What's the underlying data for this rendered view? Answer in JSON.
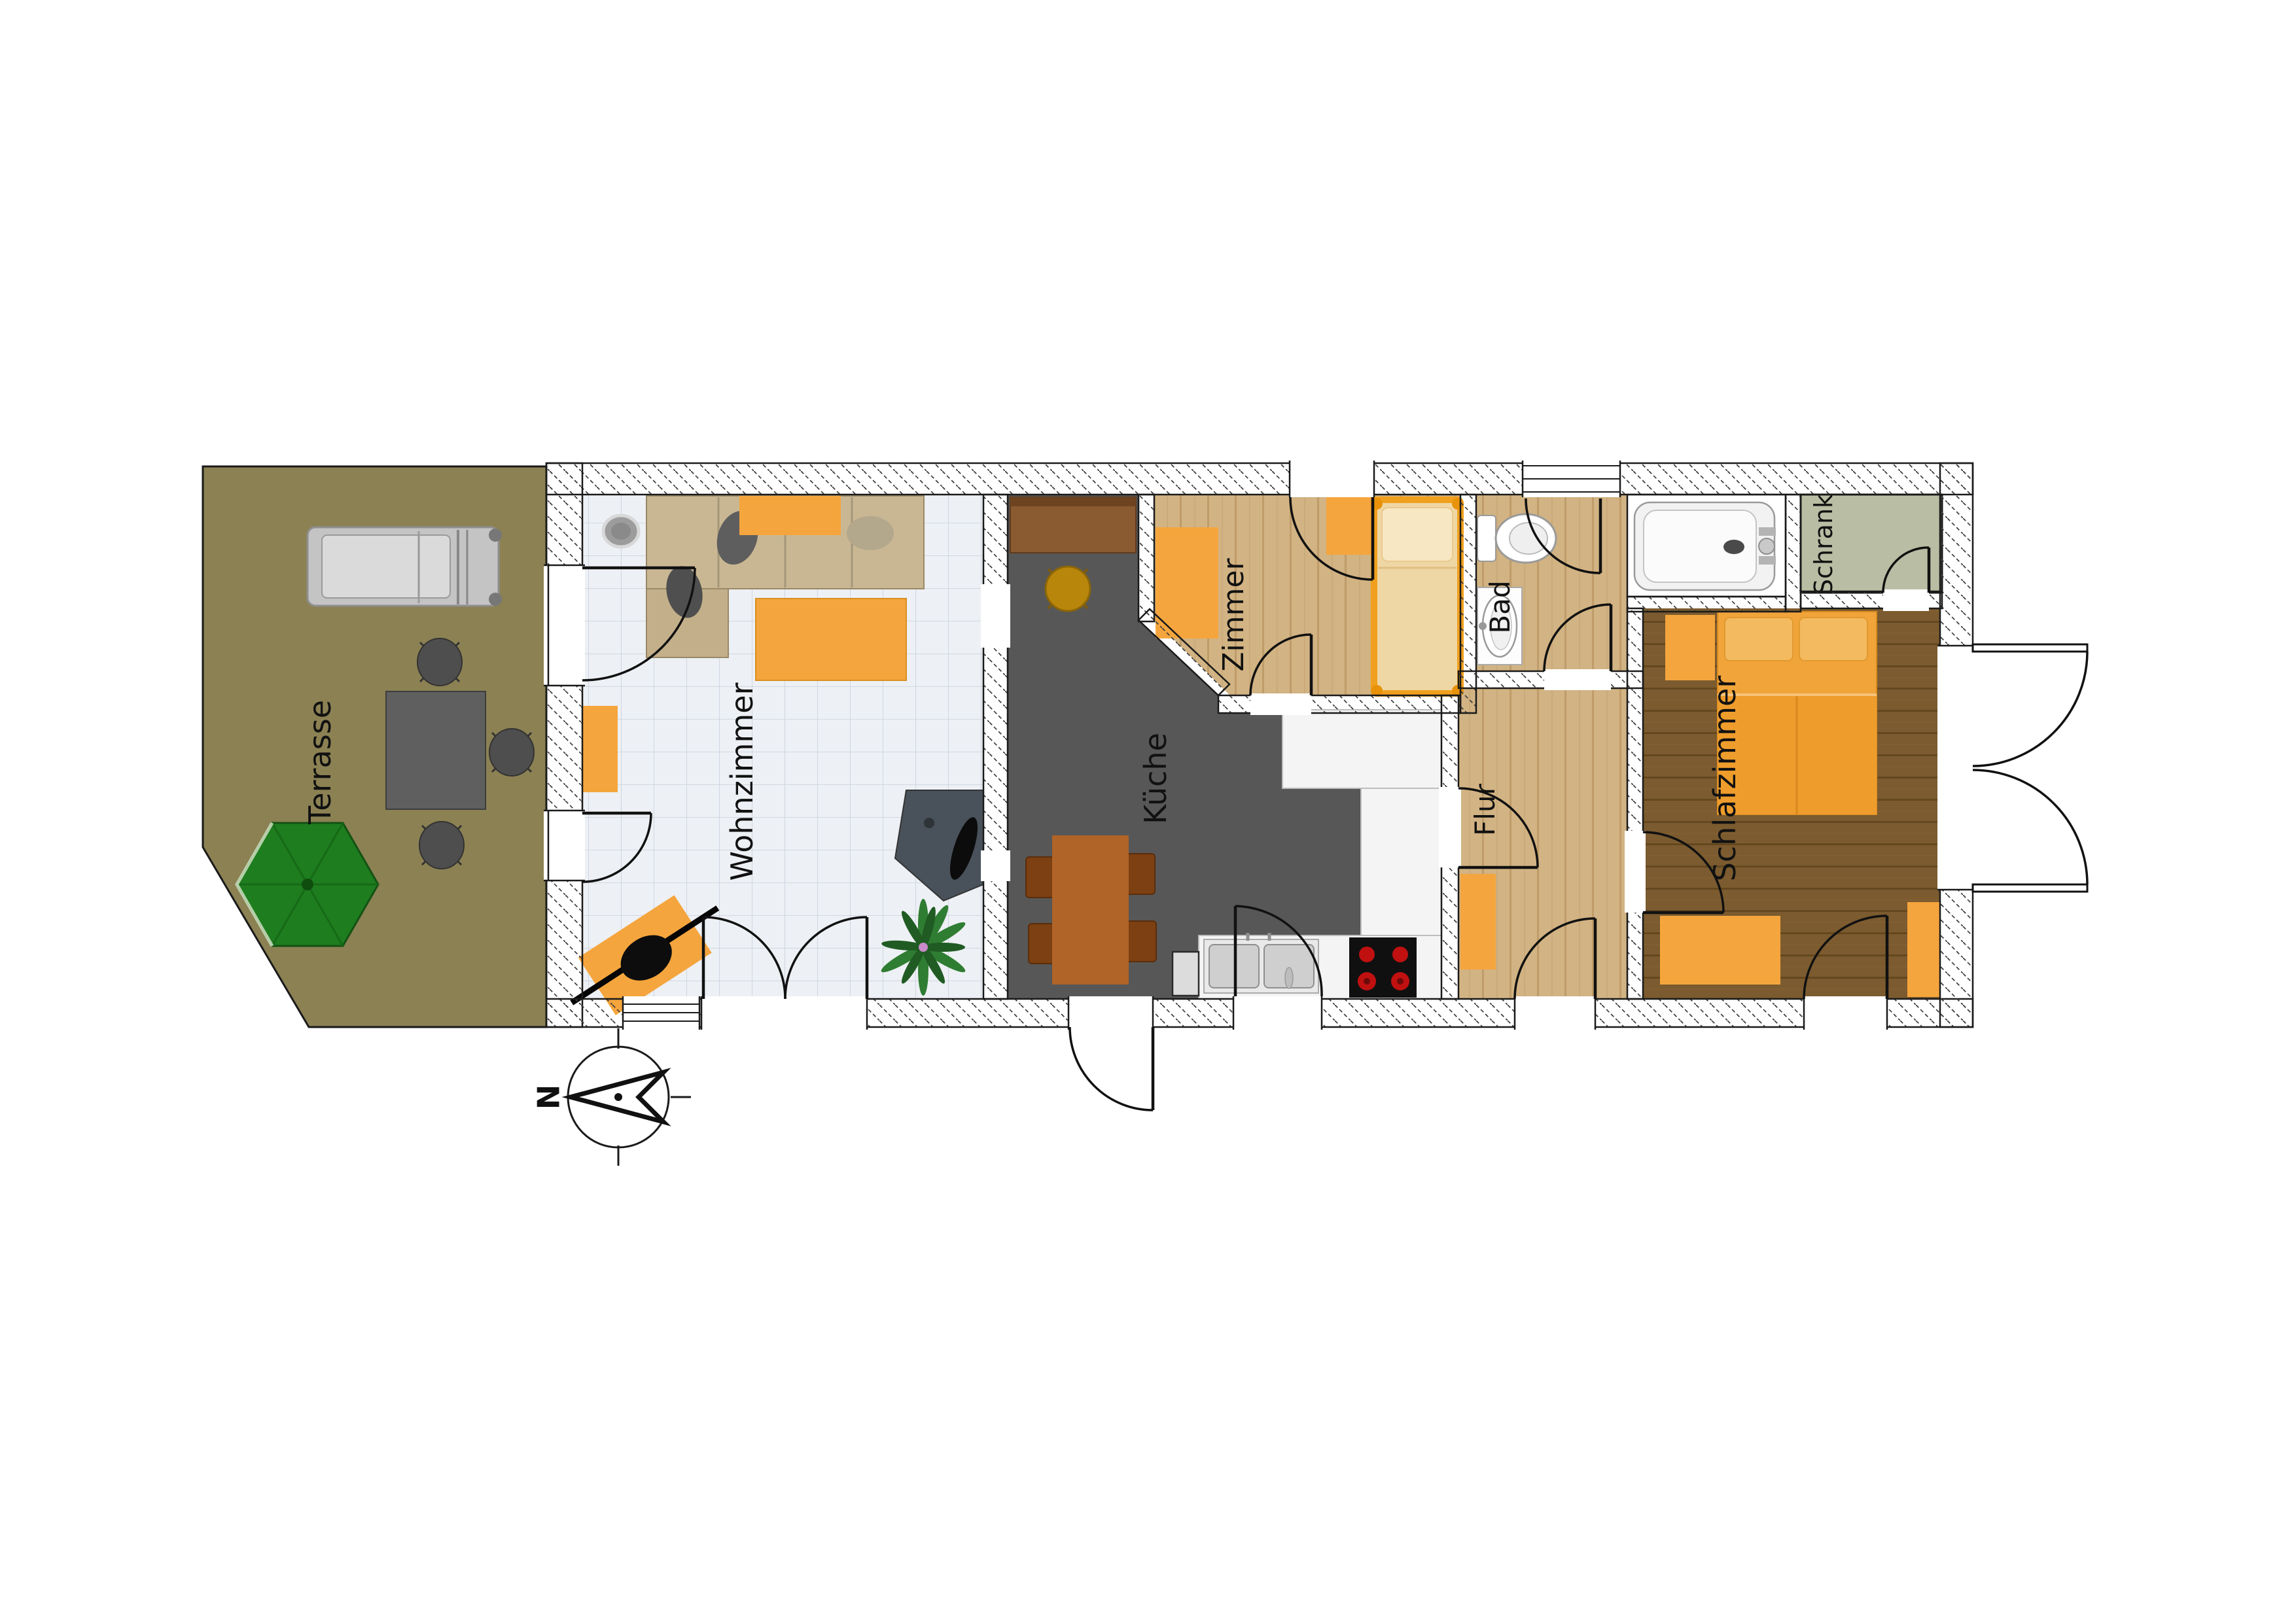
{
  "palette": {
    "background": "#ffffff",
    "terrace": "#8b8153",
    "tile_floor": "#edf0f4",
    "kitchen_floor": "#575757",
    "tan_floor": "#d2b383",
    "wood_floor": "#7b5b2f",
    "closet_floor": "#b9bda3",
    "accent_orange": "#f5a53d",
    "counter_white": "#f4f4f4",
    "parasol_green": "#1e7d1e",
    "wall_outline": "#1a1a1a"
  },
  "rooms": [
    {
      "id": "terrasse",
      "label": "Terrasse"
    },
    {
      "id": "wohnzimmer",
      "label": "Wohnzimmer"
    },
    {
      "id": "kueche",
      "label": "Küche"
    },
    {
      "id": "zimmer",
      "label": "Zimmer"
    },
    {
      "id": "bad",
      "label": "Bad"
    },
    {
      "id": "schrank",
      "label": "Schrank"
    },
    {
      "id": "flur",
      "label": "Flur"
    },
    {
      "id": "schlafzimmer",
      "label": "Schlafzimmer"
    }
  ],
  "compass": {
    "north_label": "N"
  },
  "furniture": {
    "terrasse": [
      "sun-lounger",
      "garden-table",
      "garden-chairs",
      "parasol"
    ],
    "wohnzimmer": [
      "corner-sofa",
      "side-table",
      "sofa-throw",
      "coffee-table",
      "sideboard",
      "tv-stand",
      "desk-with-chair",
      "plant"
    ],
    "kueche": [
      "cabinet",
      "stool",
      "dining-table",
      "dining-chairs",
      "counter",
      "sink",
      "stove"
    ],
    "zimmer": [
      "desk",
      "side-table",
      "single-bed"
    ],
    "bad": [
      "toilet",
      "washbasin",
      "bathtub"
    ],
    "flur": [
      "wardrobe"
    ],
    "schlafzimmer": [
      "double-bed",
      "nightstand",
      "dresser",
      "nightstand-right"
    ]
  }
}
